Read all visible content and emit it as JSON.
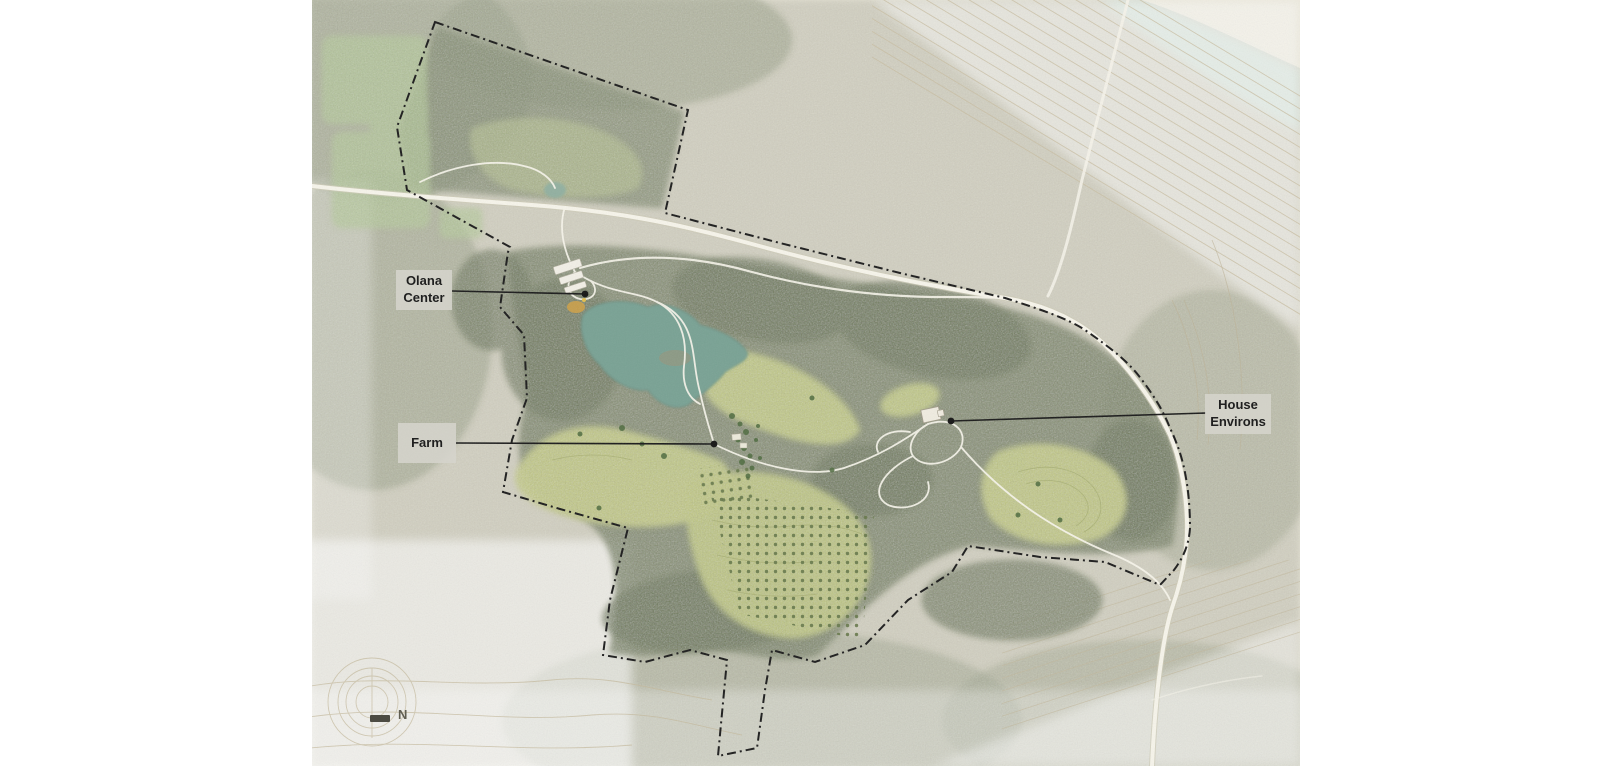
{
  "map": {
    "region_labels": {
      "olana_center": "Olana Center",
      "farm": "Farm",
      "house_environs": "House Environs"
    },
    "north_indicator": {
      "label": "N"
    },
    "colors": {
      "page_background": "#ffffff",
      "map_base": "#e9e6d8",
      "lake": "#79a294",
      "pond": "#8fb0a2",
      "river": "#cfe3da",
      "meadow": "#c6ce83",
      "orchard_field": "#c2ca7e",
      "north_parcel_field": "#b9c490",
      "outside_field": "#b5cd97",
      "forest_dark": "#76815f",
      "forest_clump": "#65724e",
      "forest_outer": "#98a084",
      "road": "#f7f5eb",
      "boundary": "#1c1c1c",
      "leader_line": "#1a1a1a",
      "label_background": "#d5d4cc",
      "label_text": "#1f1f1f",
      "contour_line": "#c8bda1",
      "building": "#f2efe6",
      "olana_center_accent": "#d0a145"
    }
  }
}
